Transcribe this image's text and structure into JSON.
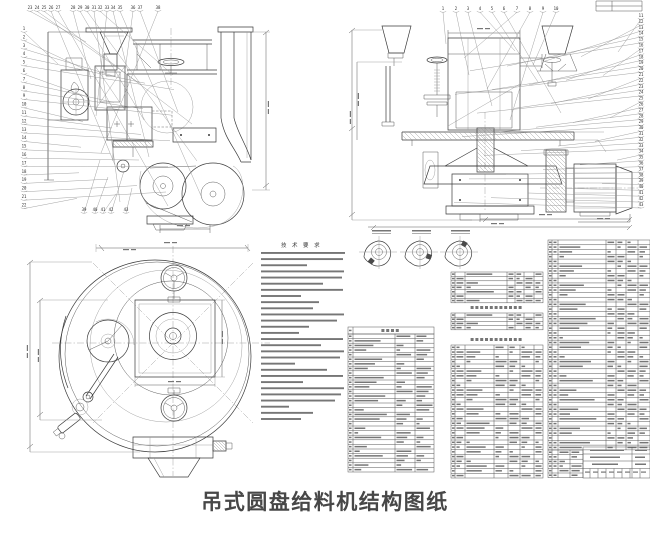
{
  "page": {
    "caption": "吊式圆盘给料机结构图纸"
  },
  "drawing": {
    "notes_title": "技 术 要 求",
    "callouts": {
      "side_top": [
        "23",
        "24",
        "25",
        "26",
        "27",
        "28",
        "29",
        "30",
        "31",
        "32",
        "33",
        "34",
        "35",
        "36",
        "37",
        "38"
      ],
      "side_left": [
        "1",
        "2",
        "3",
        "4",
        "5",
        "6",
        "7",
        "8",
        "9",
        "10",
        "11",
        "12",
        "13",
        "14",
        "15",
        "16",
        "17",
        "18",
        "19",
        "20",
        "21",
        "22"
      ],
      "side_bottom": [
        "39",
        "40",
        "41",
        "42",
        "43"
      ],
      "section_top": [
        "1",
        "2",
        "3",
        "4",
        "5",
        "6",
        "7",
        "8",
        "9",
        "10"
      ],
      "section_right": [
        "11",
        "12",
        "13",
        "14",
        "15",
        "16",
        "17",
        "18",
        "19",
        "20",
        "21",
        "22",
        "23",
        "24",
        "25",
        "26",
        "27",
        "28",
        "29",
        "30",
        "31",
        "32",
        "33",
        "34",
        "35",
        "36",
        "37",
        "38",
        "39",
        "40",
        "41",
        "42",
        "43"
      ]
    },
    "colors": {
      "ink": "#3b3b3b",
      "light_ink": "#9a9a9a",
      "text_sim": "#6f6f6f",
      "paper": "#ffffff",
      "caption_text": "#474747"
    }
  }
}
